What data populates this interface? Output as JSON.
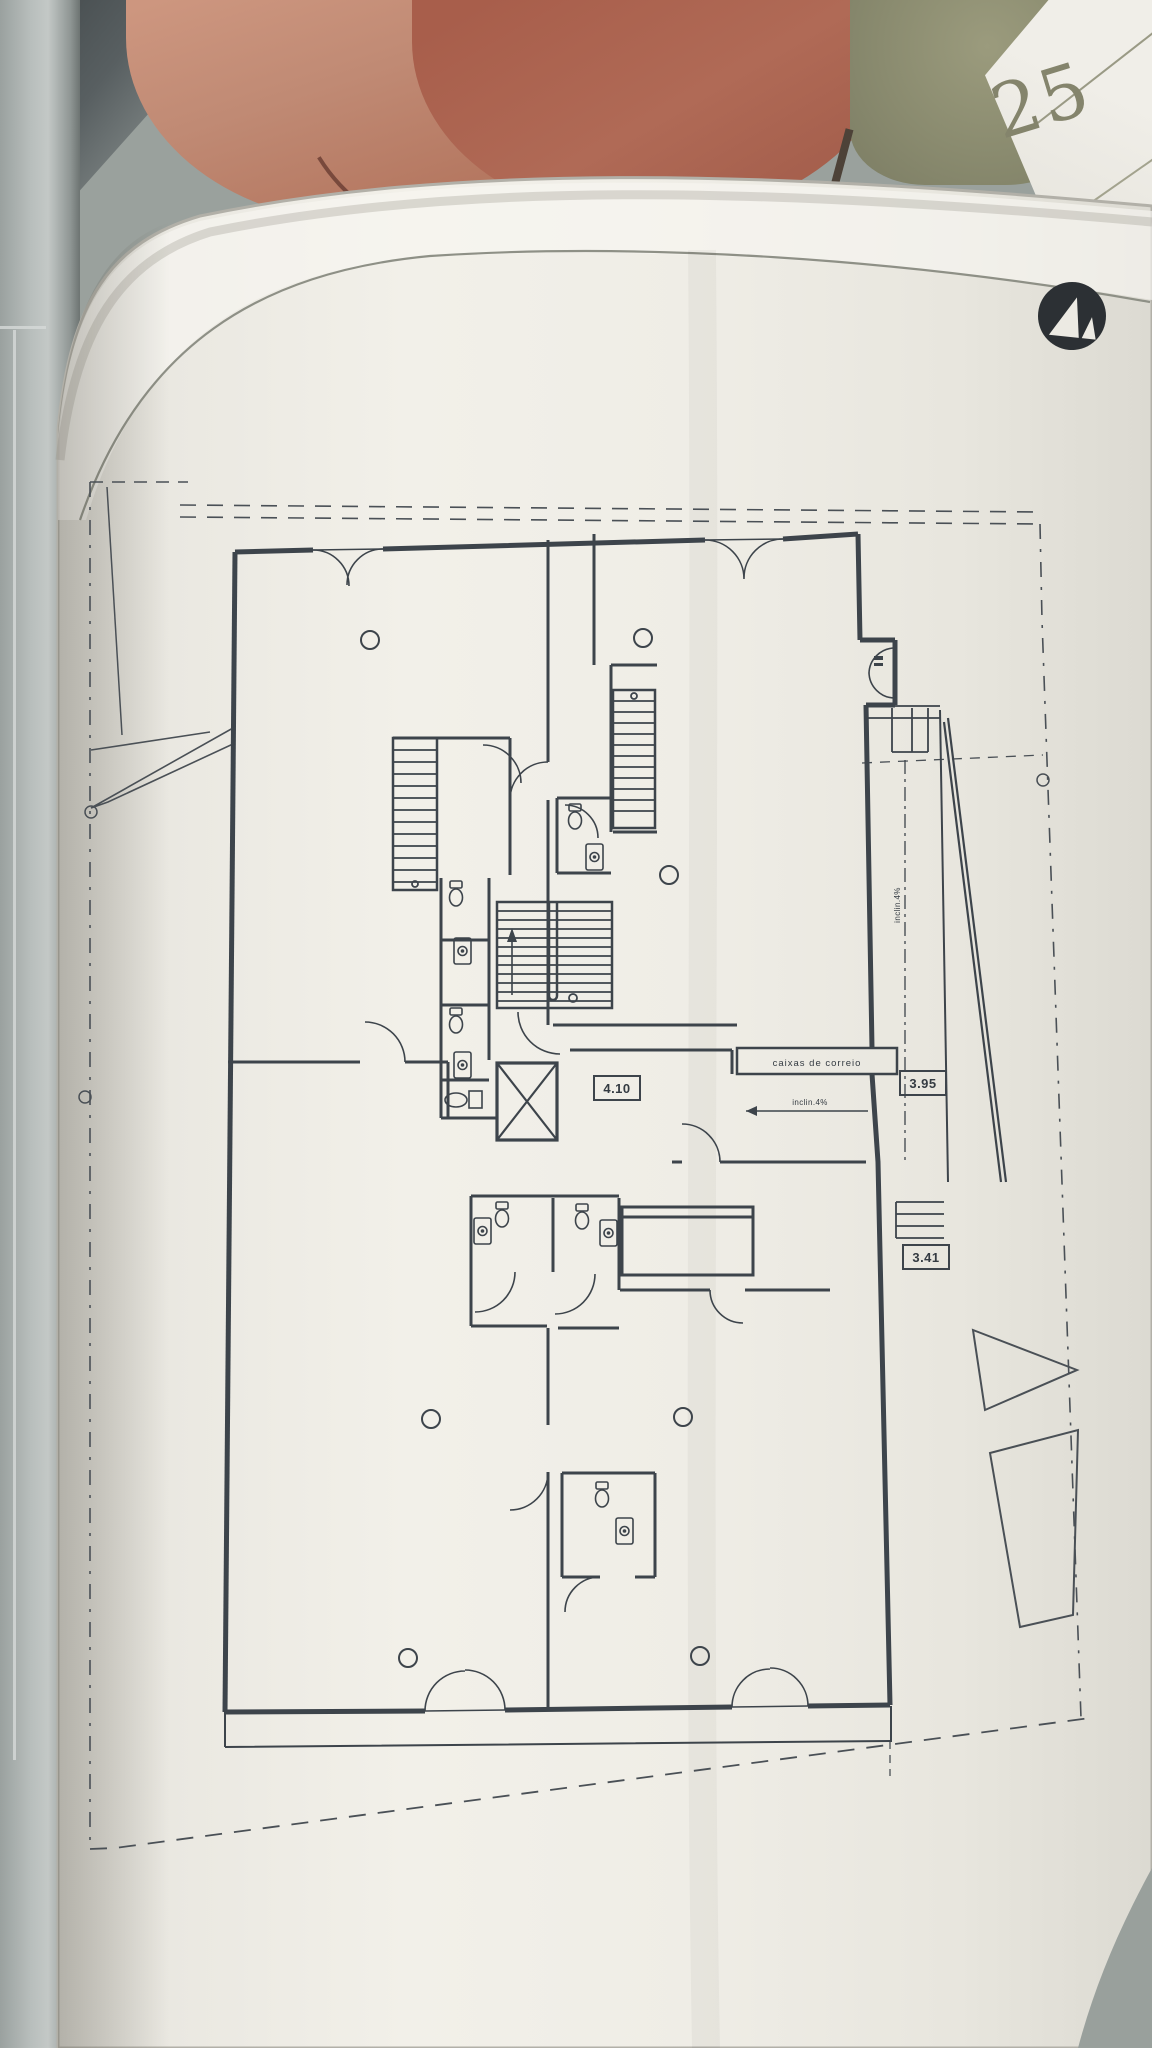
{
  "background": {
    "sheet_number": "25",
    "colors": {
      "paper": "#f0eee7",
      "ink": "#3d444b",
      "leather_object": "#b06a56",
      "olive_object": "#8a8b6f",
      "wall": "#b9bfbd",
      "logo": "#2c3034"
    }
  },
  "logo": {
    "icon": "triangles-monogram",
    "shape": "black circle with two white triangles"
  },
  "plan": {
    "labels": {
      "mailboxes": "caixas de correio",
      "hall_width": "4.10",
      "ramp_width_top": "3.95",
      "ramp_width_bottom": "3.41",
      "ramp_slope": "inclin.4%",
      "entry_slope": "inclin.4%"
    }
  }
}
